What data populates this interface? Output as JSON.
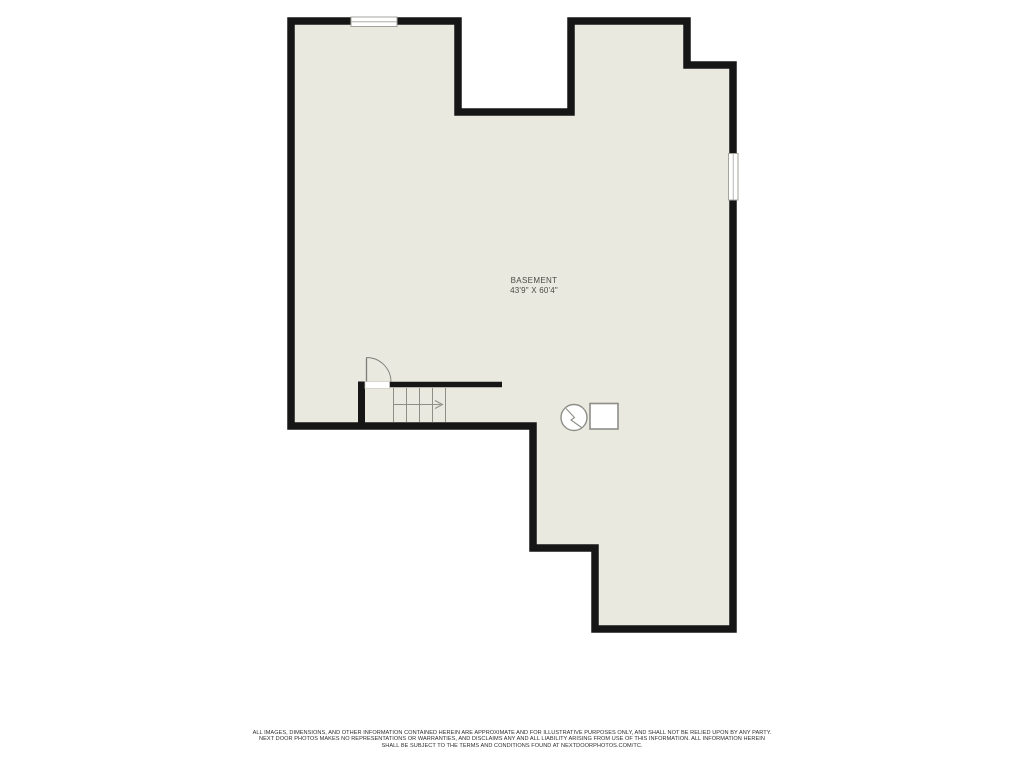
{
  "floor_plan": {
    "room": {
      "name": "BASEMENT",
      "dimensions": "43'9\" X 60'4\""
    },
    "symbols": [
      {
        "name": "door-swing-icon"
      },
      {
        "name": "staircase-icon"
      },
      {
        "name": "stair-direction-arrow-icon"
      },
      {
        "name": "water-heater-icon"
      },
      {
        "name": "furnace-icon"
      },
      {
        "name": "window-top-icon"
      },
      {
        "name": "window-right-icon"
      }
    ],
    "colors": {
      "background": "#ffffff",
      "floor_fill": "#e9e9e0",
      "wall": "#161616",
      "detail_gray": "#8e8e88",
      "label_text": "#4b4b46",
      "disclaimer_text": "#2e2e2e"
    }
  },
  "disclaimer": {
    "line1": "ALL IMAGES, DIMENSIONS, AND OTHER INFORMATION CONTAINED HEREIN ARE APPROXIMATE AND FOR ILLUSTRATIVE PURPOSES ONLY, AND SHALL NOT BE RELIED UPON BY ANY PARTY.",
    "line2": "NEXT DOOR PHOTOS MAKES NO REPRESENTATIONS OR WARRANTIES, AND DISCLAIMS ANY AND ALL LIABILITY ARISING FROM USE OF THIS INFORMATION. ALL INFORMATION HEREIN",
    "line3": "SHALL BE SUBJECT TO THE TERMS AND CONDITIONS FOUND AT NEXTDOORPHOTOS.COM/TC."
  }
}
